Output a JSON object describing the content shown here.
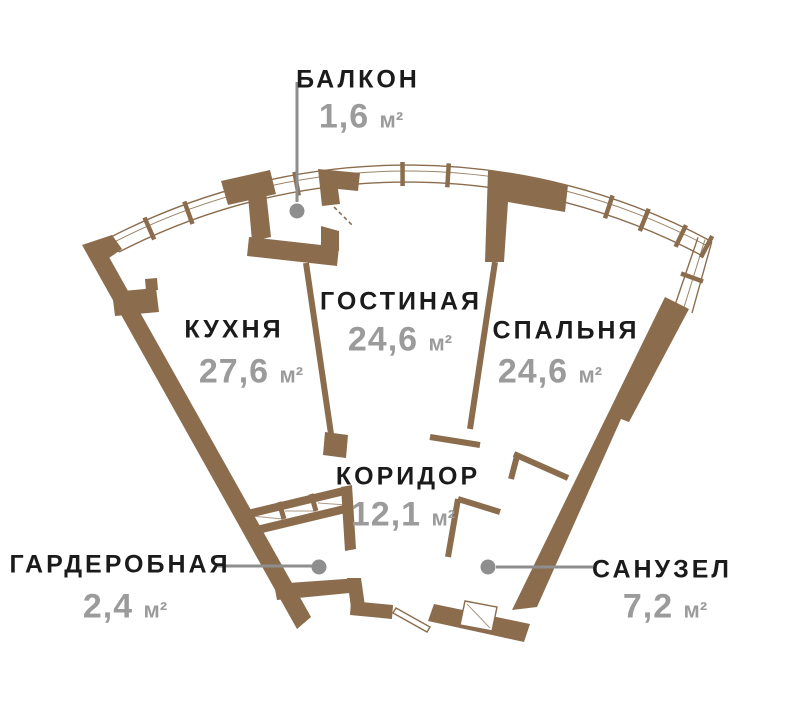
{
  "colors": {
    "wall": "#8b6d4e",
    "name": "#1b1b1b",
    "area": "#9b9b9b",
    "leader": "#8e8e8e",
    "bg": "#ffffff"
  },
  "rooms": [
    {
      "id": "balcony",
      "name": "БАЛКОН",
      "area": "1,6",
      "unit": "м²"
    },
    {
      "id": "kitchen",
      "name": "КУХНЯ",
      "area": "27,6",
      "unit": "м²"
    },
    {
      "id": "living",
      "name": "ГОСТИНАЯ",
      "area": "24,6",
      "unit": "м²"
    },
    {
      "id": "bedroom",
      "name": "СПАЛЬНЯ",
      "area": "24,6",
      "unit": "м²"
    },
    {
      "id": "corridor",
      "name": "КОРИДОР",
      "area": "12,1",
      "unit": "м²"
    },
    {
      "id": "wardrobe",
      "name": "ГАРДЕРОБНАЯ",
      "area": "2,4",
      "unit": "м²"
    },
    {
      "id": "bathroom",
      "name": "САНУЗЕЛ",
      "area": "7,2",
      "unit": "м²"
    }
  ]
}
